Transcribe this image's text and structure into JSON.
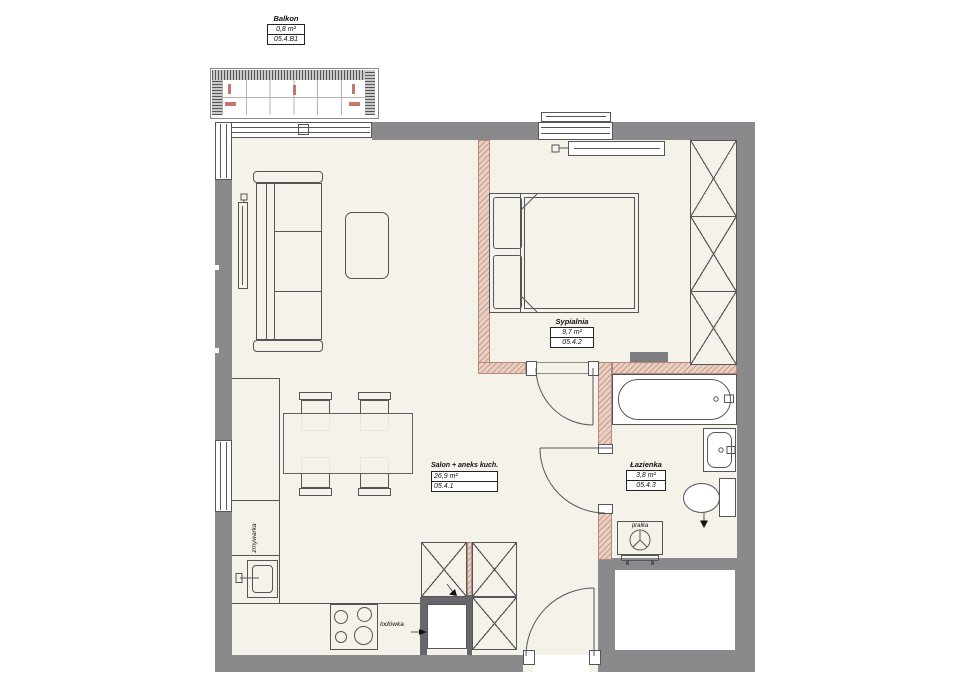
{
  "plan": {
    "rooms": [
      {
        "id": "balkon",
        "name": "Balkon",
        "area": "0,8 m²",
        "code": "05.4.B1"
      },
      {
        "id": "sypialnia",
        "name": "Sypialnia",
        "area": "9,7 m²",
        "code": "05.4.2"
      },
      {
        "id": "salon",
        "name": "Salon + aneks kuch.",
        "area": "26,9 m²",
        "code": "05.4.1"
      },
      {
        "id": "lazienka",
        "name": "Łazienka",
        "area": "3,8 m²",
        "code": "05.4.3"
      }
    ],
    "annotations": {
      "dishwasher": "zmywarka",
      "fridge": "lodówka",
      "washer": "pralka"
    },
    "colors": {
      "wall": "#8a8a8c",
      "floor": "#f5f2ea",
      "partition": "#ead0c2",
      "partition_hatch": "#c99c8d",
      "accent_marks": "#c4766b",
      "line": "#55555a"
    }
  }
}
